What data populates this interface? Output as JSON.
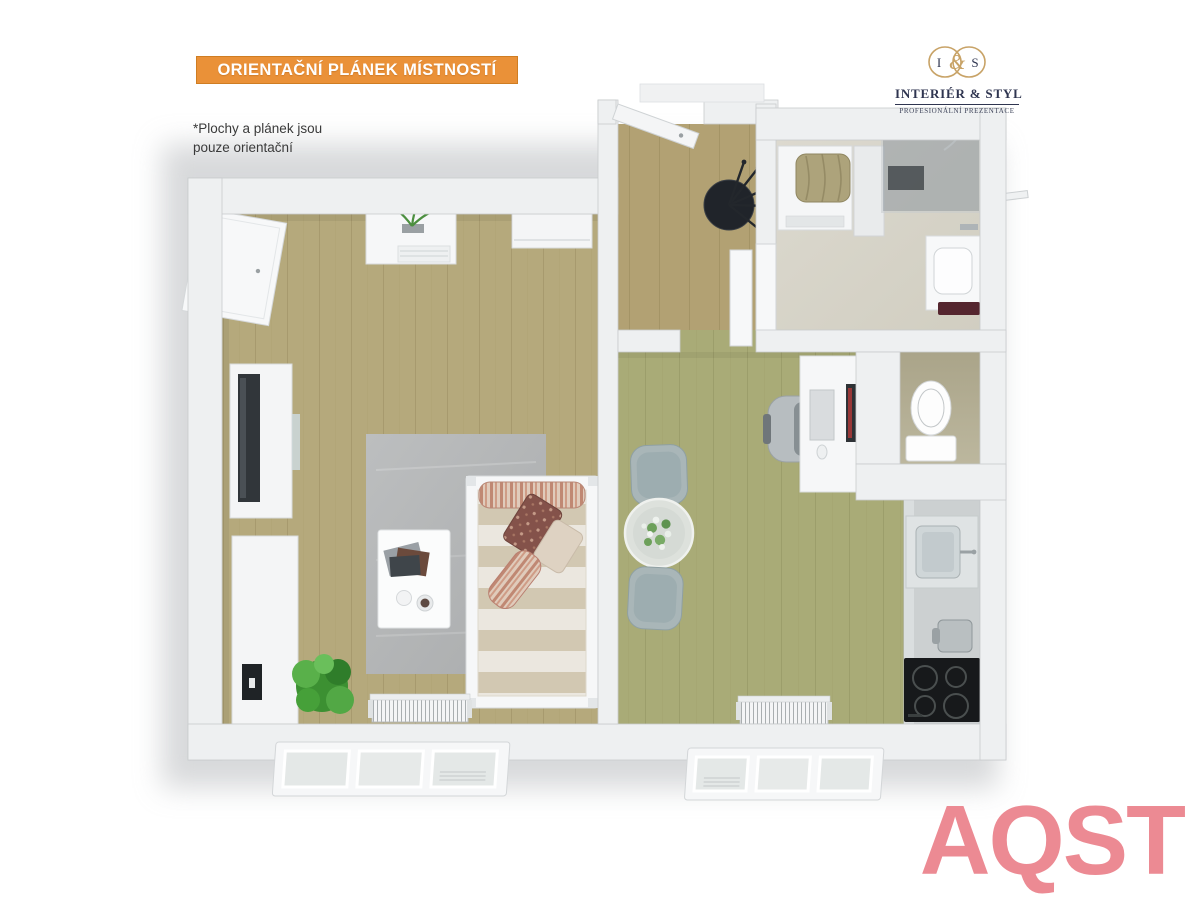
{
  "banner": {
    "label": "ORIENTAČNÍ PLÁNEK MÍSTNOSTÍ",
    "bg_color": "#ea9138",
    "border_color": "#cf7d22",
    "text_color": "#ffffff"
  },
  "disclaimer": {
    "line1": "*Plochy  a plánek jsou",
    "line2": "pouze orientační"
  },
  "logo": {
    "initial_left": "I",
    "ampersand": "&",
    "initial_right": "S",
    "name": "INTERIÉR & STYL",
    "tagline": "PROFESIONÁLNÍ PREZENTACE",
    "gold_color": "#c8a367",
    "navy_color": "#2f3550"
  },
  "watermark": {
    "text": "AQST",
    "color": "#ec8a93"
  },
  "floorplan": {
    "style": "3d-top-down-apartment-render",
    "rooms": [
      "living-room",
      "hallway",
      "bathroom",
      "wc",
      "kitchen-dining-room"
    ],
    "floor_colors": {
      "living_room": "#b5a97c",
      "hallway": "#b2a173",
      "kitchen_dining": "#a9ab77",
      "bathroom": "#d8d5ca",
      "wc": "#b3ae94",
      "rug": "#b4b6b7",
      "wall": "#eef0f1"
    },
    "furniture": [
      "entry-door",
      "coat-stand",
      "wardrobe-door",
      "dresser-with-plant",
      "wall-shelf",
      "tv-cabinet",
      "tv",
      "sideboard",
      "speaker",
      "floor-plant",
      "rug",
      "coffee-table",
      "daybed",
      "striped-pillows",
      "radiator",
      "tilt-window",
      "dining-table-with-flowers",
      "dining-chair",
      "desk",
      "monitor",
      "office-chair",
      "toilet",
      "kitchen-counter",
      "kitchen-sink",
      "kettle",
      "cooktop",
      "washing-machine",
      "laundry-basket",
      "shower-enclosure",
      "bathroom-vanity",
      "bath-mat",
      "towel-rail",
      "interior-door"
    ]
  }
}
